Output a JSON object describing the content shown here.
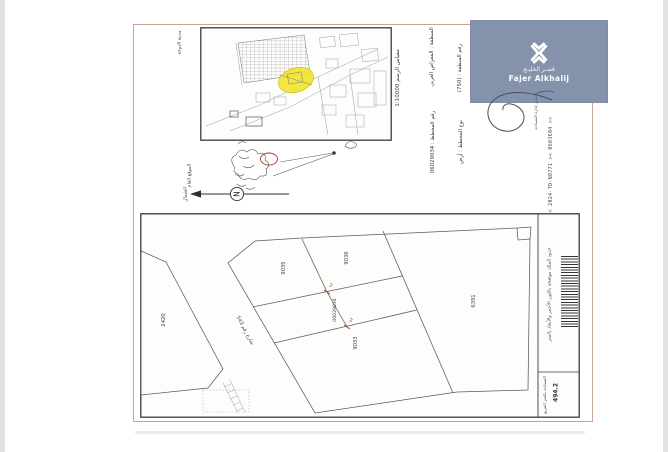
{
  "brand": {
    "name_ar": "قصـر الخليـج",
    "name_en": "Fajer Alkhalij"
  },
  "header_fields": {
    "scale": "مقياس الرسم 1:10000",
    "zone": "المنطقة : المعراض الغربي",
    "zone_no": "رقم المنطقة : (750)",
    "plan_no": "رقم المخطط : 06029034",
    "plan_type": "نوع المخطط : أرض"
  },
  "key_map": {
    "side_label": "مدينة الدوحة"
  },
  "sketch": {
    "label": "الموقع العام",
    "north_label": "الشمال",
    "north_letter": "N"
  },
  "reference_code": "<< 90804 >< 2024-TD-N0771 >< 0603604 >>",
  "signature_caption": "مدير إدارة المساحة",
  "site_plan": {
    "plots": [
      {
        "number": "2420"
      },
      {
        "number": "9035"
      },
      {
        "number": "9036"
      },
      {
        "number": "9033"
      },
      {
        "number": "6391"
      },
      {
        "number": "06029034"
      }
    ],
    "street_label": "شارع رقم 543",
    "mark_left": "م5",
    "mark_right": "م5",
    "note": "حدود الملك موضحة باللون الأحمر والأبعاد بالمتر",
    "area_label": "المساحة بالمتر المربع",
    "area_value": "494.2"
  },
  "colors": {
    "highlight": "#f2e431",
    "logo_bg": "#8493ab",
    "border_tan": "#c9a492",
    "red_mark": "#b03a2e"
  }
}
